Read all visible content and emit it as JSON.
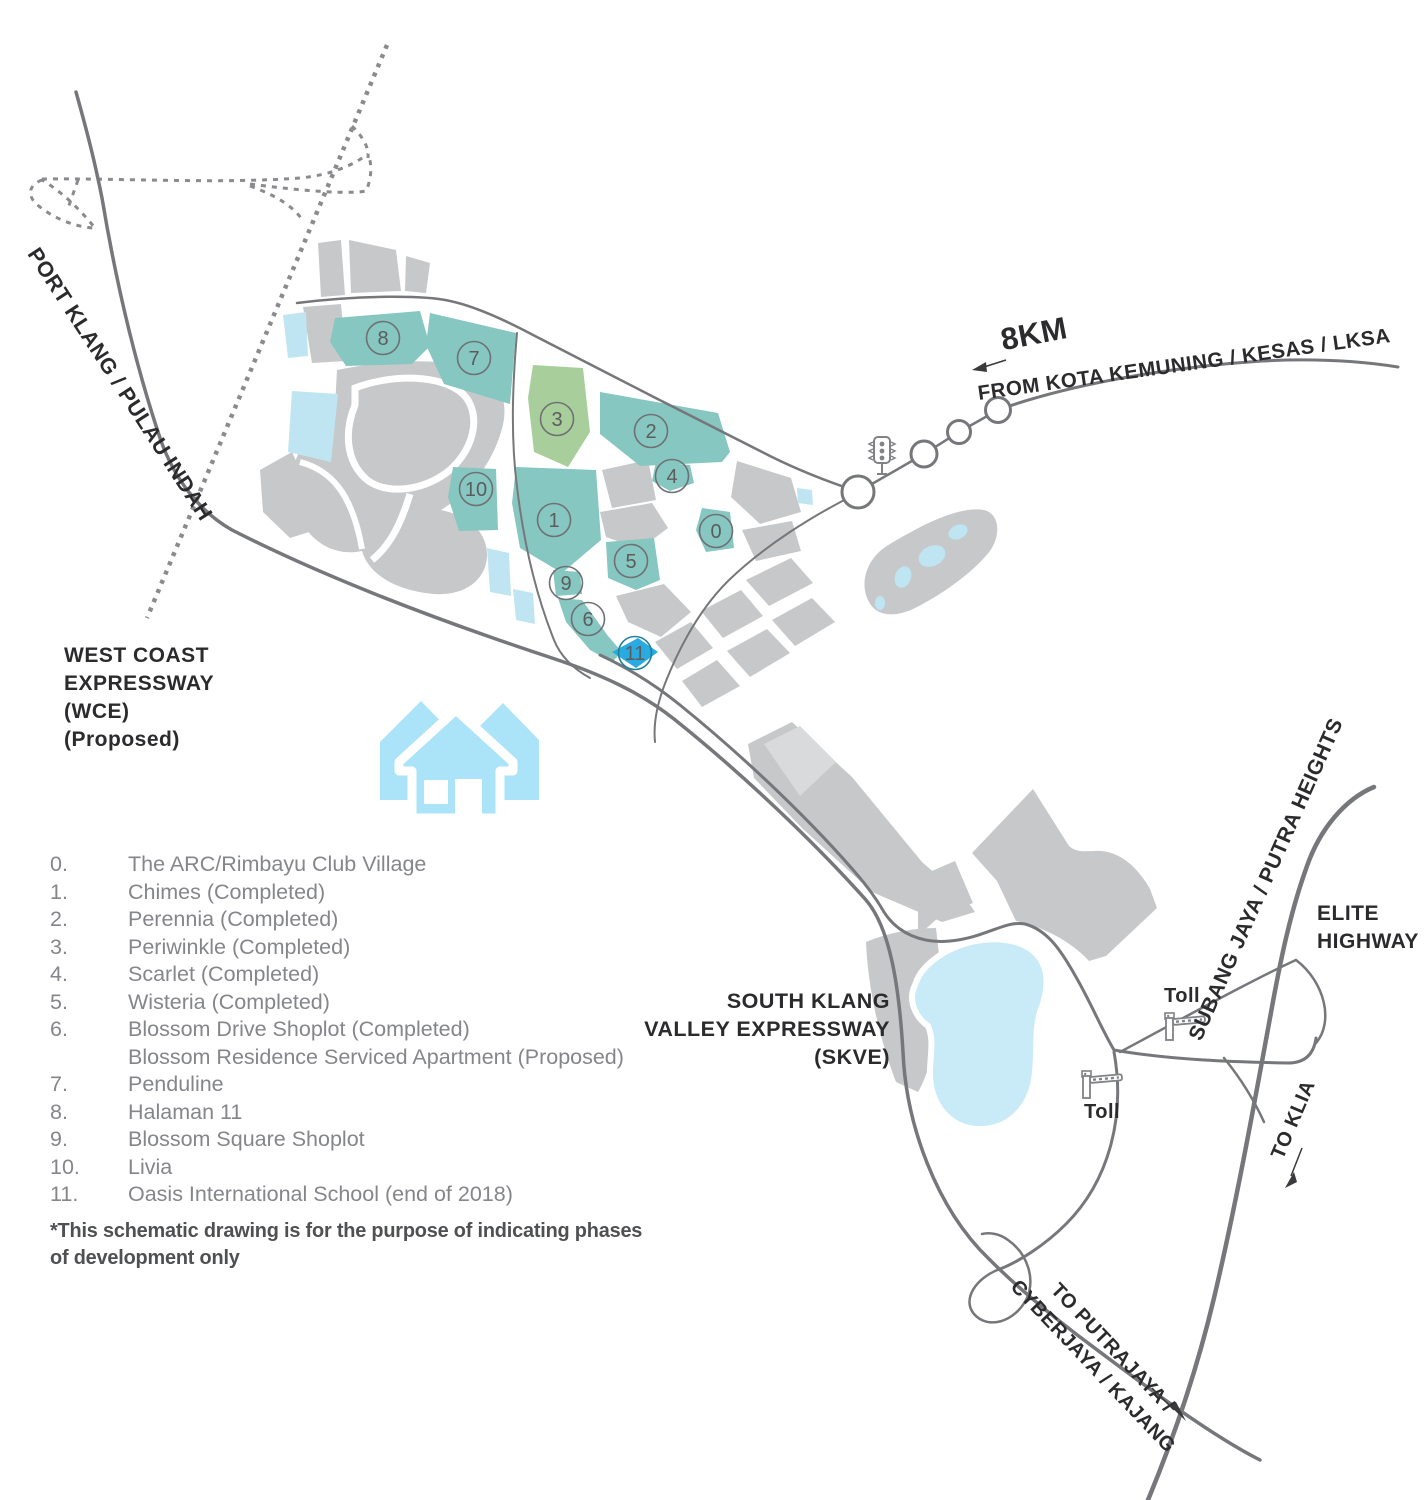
{
  "map": {
    "labels": {
      "port_klang": "PORT KLANG / PULAU INDAH",
      "wce": [
        "WEST COAST",
        "EXPRESSWAY",
        "(WCE)",
        "(Proposed)"
      ],
      "distance": "8KM",
      "from_road": "FROM KOTA KEMUNING / KESAS / LKSA",
      "skve": [
        "SOUTH KLANG",
        "VALLEY EXPRESSWAY",
        "(SKVE)"
      ],
      "subang": "SUBANG JAYA / PUTRA HEIGHTS",
      "elite": [
        "ELITE",
        "HIGHWAY"
      ],
      "to_klia": "TO KLIA",
      "to_putrajaya": [
        "TO PUTRAJAYA /",
        "CYBERJAYA / KAJANG"
      ],
      "toll_north": "Toll",
      "toll_south": "Toll"
    },
    "parcel_labels": [
      "0",
      "1",
      "2",
      "3",
      "4",
      "5",
      "6",
      "7",
      "8",
      "9",
      "10",
      "11"
    ],
    "colors": {
      "parcel_teal": "#87c7c1",
      "parcel_green": "#a8cf9b",
      "parcel_blue": "#29abe2",
      "parcel_gray": "#c7c8ca",
      "water_light": "#bfe5f2",
      "lake": "#c9ebf7",
      "house_icon": "#abe4f8",
      "road": "#76777a",
      "dotted_road": "#8a8b8e",
      "label_dark": "#2b2b2d",
      "legend_gray": "#85868a"
    }
  },
  "legend": {
    "items": [
      {
        "num": "0.",
        "text": "The ARC/Rimbayu Club Village"
      },
      {
        "num": "1.",
        "text": "Chimes (Completed)"
      },
      {
        "num": "2.",
        "text": "Perennia (Completed)"
      },
      {
        "num": "3.",
        "text": "Periwinkle (Completed)"
      },
      {
        "num": "4.",
        "text": "Scarlet (Completed)"
      },
      {
        "num": "5.",
        "text": "Wisteria (Completed)"
      },
      {
        "num": "6.",
        "text": "Blossom Drive Shoplot (Completed)"
      },
      {
        "num": "",
        "text": "Blossom Residence Serviced Apartment (Proposed)"
      },
      {
        "num": "7.",
        "text": "Penduline"
      },
      {
        "num": "8.",
        "text": "Halaman 11"
      },
      {
        "num": "9.",
        "text": "Blossom Square Shoplot"
      },
      {
        "num": "10.",
        "text": "Livia"
      },
      {
        "num": "11.",
        "text": "Oasis International School (end of 2018)"
      }
    ],
    "footnote": "*This schematic drawing is for the purpose of indicating phases of development only"
  }
}
